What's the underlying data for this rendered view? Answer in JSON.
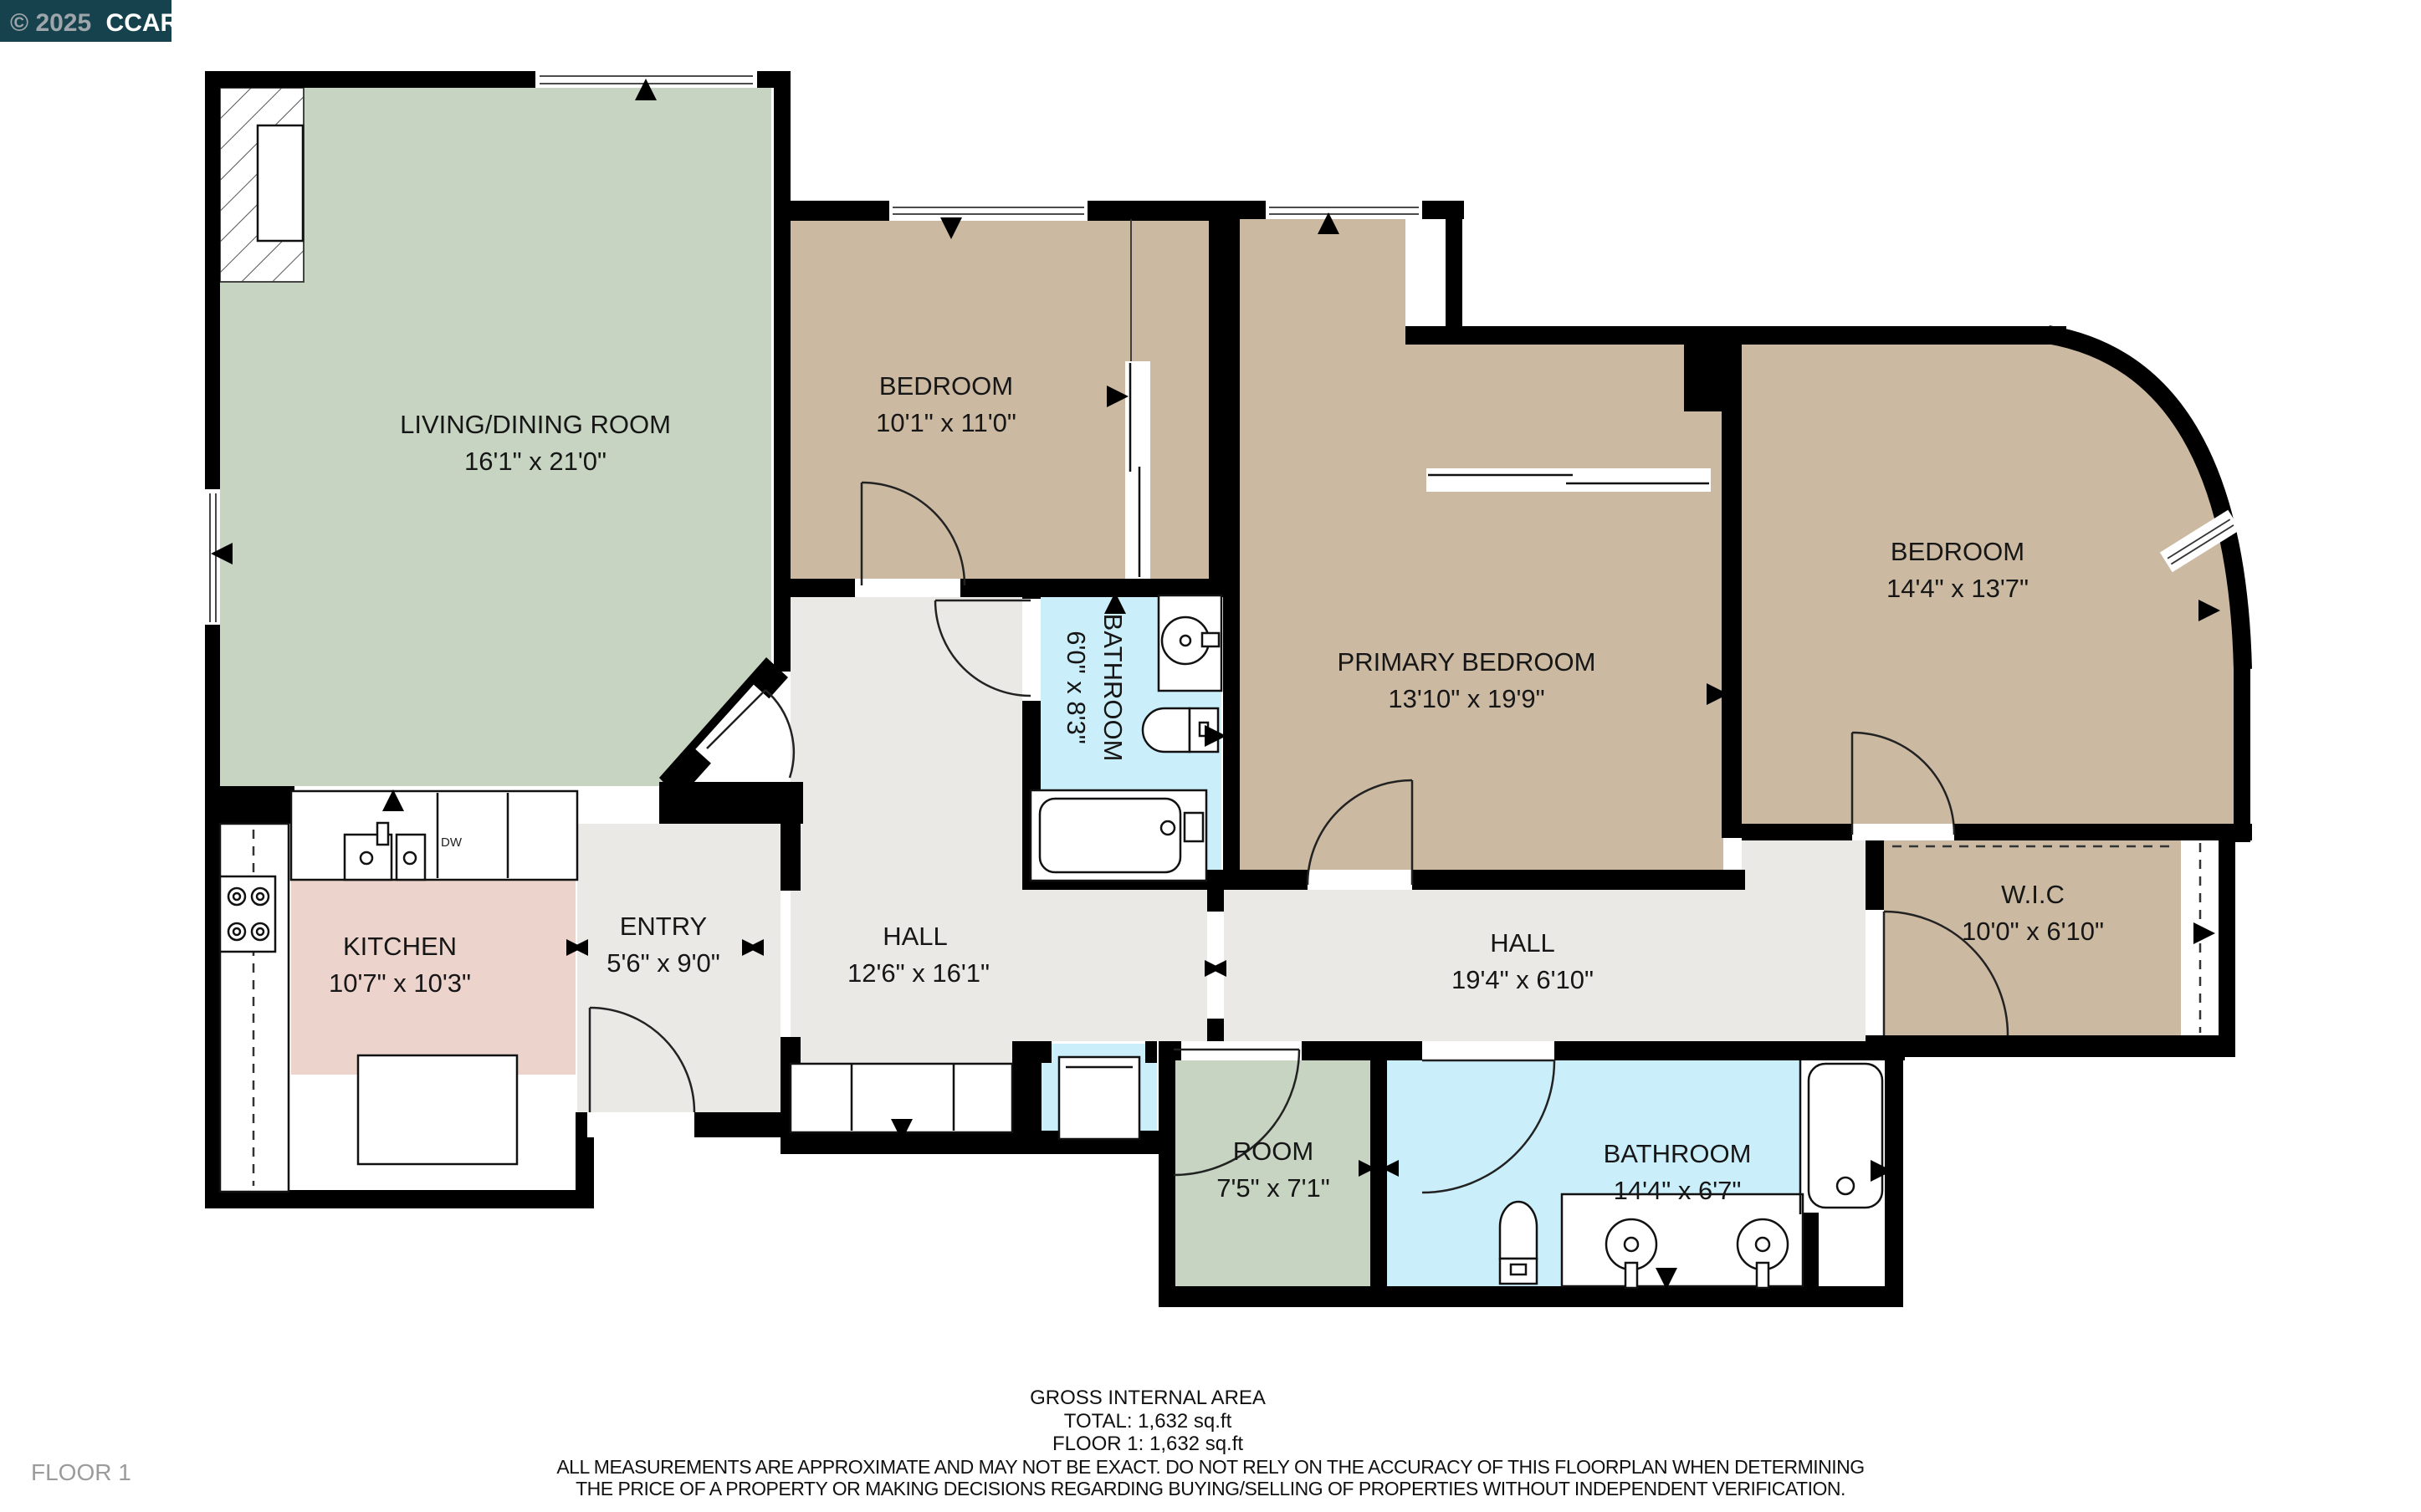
{
  "title_badge": {
    "year_part": "© 2025",
    "org": "CCAR",
    "bg_color": "#16424e",
    "muted_color": "#9fa6ab",
    "bright_color": "#ffffff"
  },
  "rooms": [
    {
      "name": "LIVING/DINING ROOM",
      "dims": "16'1\" x 21'0\"",
      "fill": "#c7d4c2"
    },
    {
      "name": "BEDROOM",
      "dims": "10'1\" x 11'0\"",
      "fill": "#cbb9a2"
    },
    {
      "name": "PRIMARY BEDROOM",
      "dims": "13'10\" x 19'9\"",
      "fill": "#cbb9a2"
    },
    {
      "name": "BEDROOM",
      "dims": "14'4\" x 13'7\"",
      "fill": "#cbb9a2"
    },
    {
      "name": "BATHROOM",
      "dims": "6'0\" x 8'3\"",
      "fill": "#caeefa"
    },
    {
      "name": "KITCHEN",
      "dims": "10'7\" x 10'3\"",
      "fill": "#ecd4cc"
    },
    {
      "name": "ENTRY",
      "dims": "5'6\" x 9'0\"",
      "fill": "#eae9e6"
    },
    {
      "name": "HALL",
      "dims": "12'6\" x 16'1\"",
      "fill": "#eae9e6"
    },
    {
      "name": "HALL",
      "dims": "19'4\" x 6'10\"",
      "fill": "#eae9e6"
    },
    {
      "name": "W.I.C",
      "dims": "10'0\" x 6'10\"",
      "fill": "#cbb9a2"
    },
    {
      "name": "ROOM",
      "dims": "7'5\" x 7'1\"",
      "fill": "#c7d4c2"
    },
    {
      "name": "BATHROOM",
      "dims": "14'4\" x 6'7\"",
      "fill": "#caeefa"
    }
  ],
  "appliances": {
    "dishwasher": "DW"
  },
  "summary": {
    "heading": "GROSS INTERNAL AREA",
    "total": "TOTAL: 1,632 sq.ft",
    "floor1": "FLOOR 1: 1,632 sq.ft",
    "disclaimer_line1": "ALL MEASUREMENTS ARE APPROXIMATE AND MAY NOT BE EXACT. DO NOT RELY ON THE ACCURACY OF THIS FLOORPLAN WHEN DETERMINING",
    "disclaimer_line2": "THE PRICE OF A PROPERTY OR MAKING DECISIONS REGARDING BUYING/SELLING OF PROPERTIES WITHOUT INDEPENDENT VERIFICATION."
  },
  "floor_label": "FLOOR 1",
  "colors": {
    "wall": "#000000",
    "hall_floor": "#eae9e6",
    "bedroom_floor": "#cbb9a2",
    "living_floor": "#c7d4c2",
    "bath_floor": "#caeefa",
    "kitchen_floor": "#ecd4cc"
  }
}
